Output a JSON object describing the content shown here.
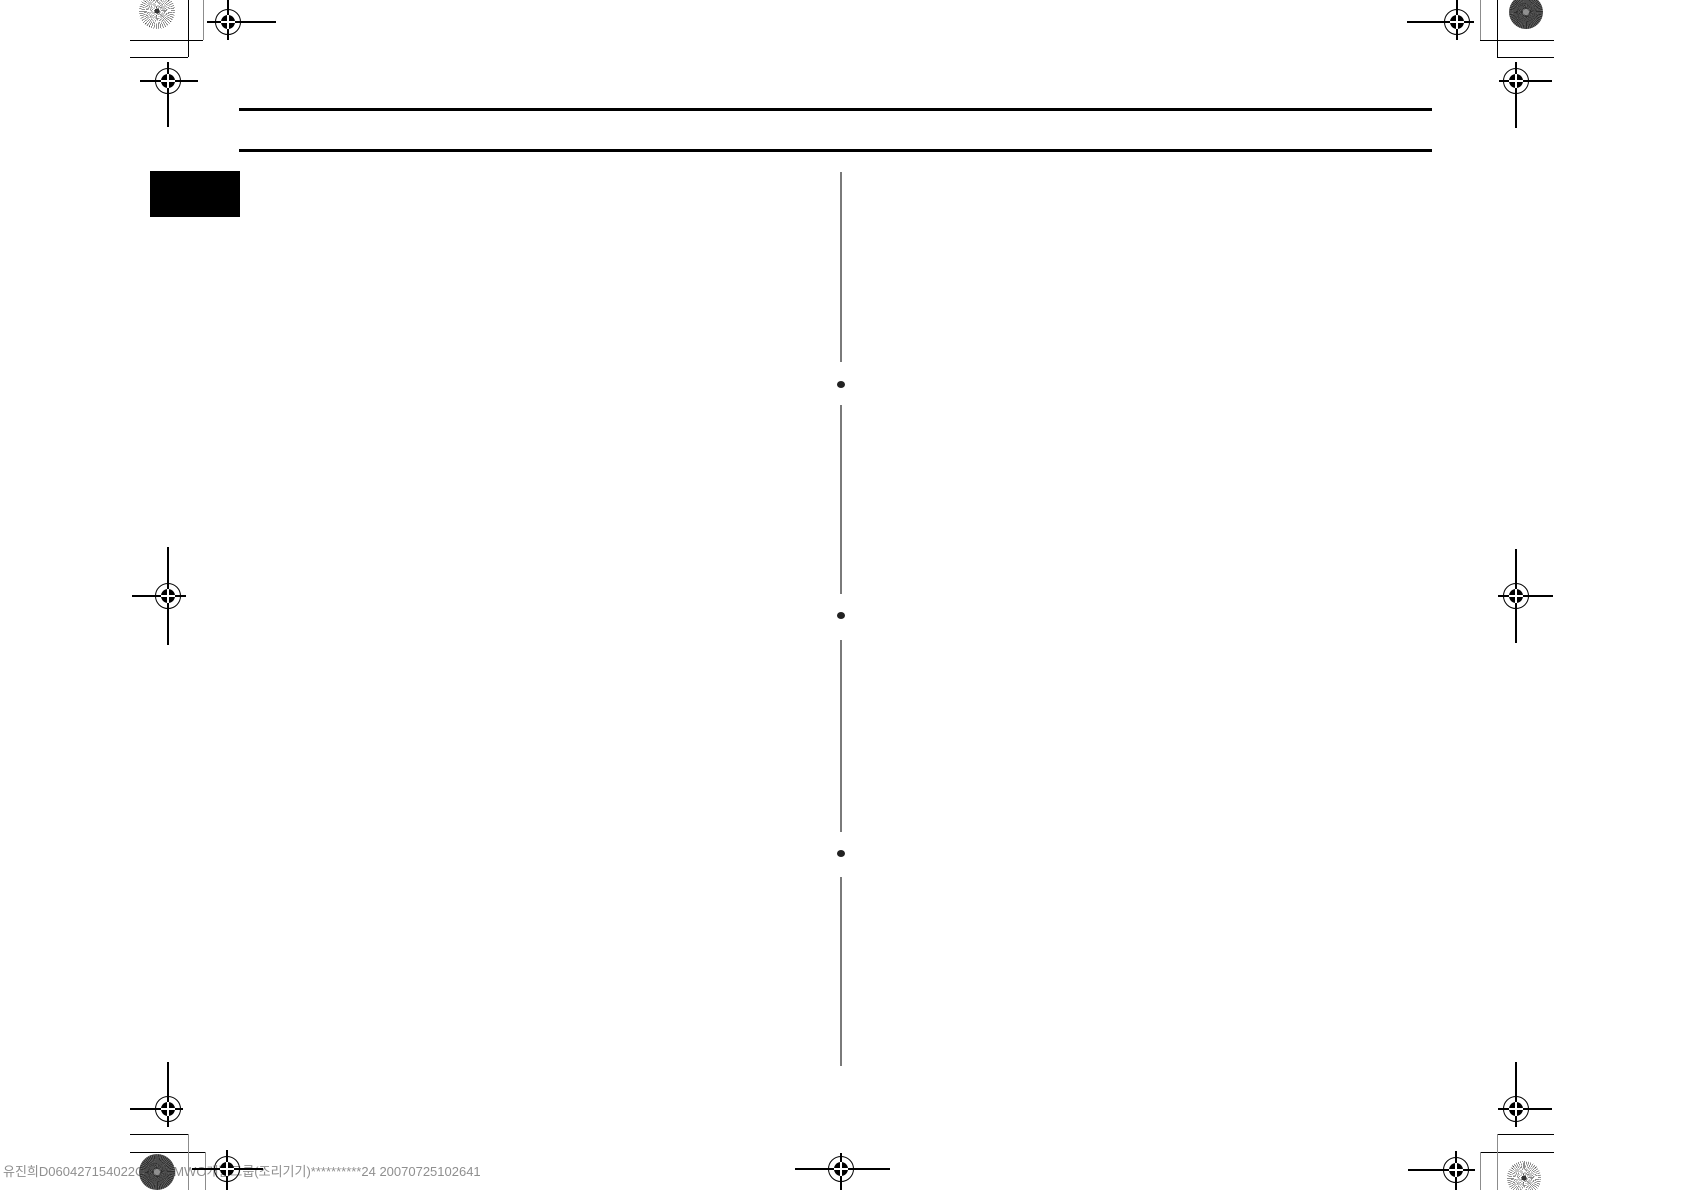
{
  "page": {
    "width": 1684,
    "height": 1190,
    "background": "#ffffff"
  },
  "footer": {
    "left_text": "유진희D060427154022C1",
    "right_text": "2MWO개발그룹(조리기기)**********24 20070725102641"
  },
  "colors": {
    "rule": "#000000",
    "tab": "#000000",
    "divider": "#7a7a7a",
    "bullet": "#222222",
    "mark": "#000000",
    "mark_gray": "#8c8c8c",
    "footer": "#8f8f8f"
  },
  "geometry": {
    "header_rules": [
      {
        "x": 239,
        "y": 108,
        "w": 1193,
        "h": 3
      },
      {
        "x": 239,
        "y": 149,
        "w": 1193,
        "h": 3
      }
    ],
    "section_tab": {
      "x": 150,
      "y": 171,
      "w": 90,
      "h": 46
    },
    "divider": {
      "x": 840,
      "w": 2,
      "segments": [
        [
          172,
          362
        ],
        [
          405,
          594
        ],
        [
          640,
          832
        ],
        [
          877,
          1066
        ]
      ]
    },
    "bullets": [
      {
        "x": 841,
        "y": 384
      },
      {
        "x": 841,
        "y": 615
      },
      {
        "x": 841,
        "y": 853
      }
    ],
    "reg_marks": [
      {
        "x": 228,
        "y": 22,
        "l": 21,
        "r": 48,
        "u": 22,
        "d": 18
      },
      {
        "x": 168,
        "y": 81,
        "l": 28,
        "r": 30,
        "u": 19,
        "d": 46
      },
      {
        "x": 1457,
        "y": 22,
        "l": 50,
        "r": 17,
        "u": 22,
        "d": 18
      },
      {
        "x": 1516,
        "y": 81,
        "l": 17,
        "r": 36,
        "u": 19,
        "d": 47
      },
      {
        "x": 168,
        "y": 596,
        "l": 36,
        "r": 18,
        "u": 49,
        "d": 49
      },
      {
        "x": 1516,
        "y": 596,
        "l": 18,
        "r": 37,
        "u": 47,
        "d": 47
      },
      {
        "x": 168,
        "y": 1109,
        "l": 38,
        "r": 15,
        "u": 47,
        "d": 18
      },
      {
        "x": 1516,
        "y": 1109,
        "l": 18,
        "r": 36,
        "u": 47,
        "d": 18
      },
      {
        "x": 227,
        "y": 1169,
        "l": 35,
        "r": 36,
        "u": 19,
        "d": 21
      },
      {
        "x": 1456,
        "y": 1170,
        "l": 48,
        "r": 19,
        "u": 19,
        "d": 20
      },
      {
        "x": 841,
        "y": 1169,
        "l": 46,
        "r": 49,
        "u": 16,
        "d": 21
      }
    ],
    "pinwheels": [
      {
        "x": 157,
        "y": 11,
        "r": 18,
        "v": "light"
      },
      {
        "x": 1526,
        "y": 12,
        "r": 17,
        "v": "dark"
      },
      {
        "x": 157,
        "y": 1172,
        "r": 18,
        "v": "dark"
      },
      {
        "x": 1524,
        "y": 1178,
        "r": 17,
        "v": "light"
      }
    ],
    "corner_lines": [
      {
        "x": 130,
        "y": 40,
        "w": 73,
        "h": 1.4,
        "s": "k"
      },
      {
        "x": 130,
        "y": 57,
        "w": 58,
        "h": 1.4,
        "s": "k"
      },
      {
        "x": 188,
        "y": 0,
        "w": 1.4,
        "h": 57,
        "s": "k"
      },
      {
        "x": 203,
        "y": 0,
        "w": 1.2,
        "h": 40,
        "s": "g"
      },
      {
        "x": 1480,
        "y": 40,
        "w": 74,
        "h": 1.4,
        "s": "k"
      },
      {
        "x": 1497,
        "y": 57,
        "w": 57,
        "h": 1.4,
        "s": "k"
      },
      {
        "x": 1497,
        "y": 0,
        "w": 1.4,
        "h": 57,
        "s": "k"
      },
      {
        "x": 1480,
        "y": 0,
        "w": 1.2,
        "h": 40,
        "s": "g"
      },
      {
        "x": 130,
        "y": 1134,
        "w": 58,
        "h": 1.4,
        "s": "k"
      },
      {
        "x": 130,
        "y": 1152,
        "w": 75,
        "h": 1.4,
        "s": "k"
      },
      {
        "x": 188,
        "y": 1134,
        "w": 1.2,
        "h": 56,
        "s": "g"
      },
      {
        "x": 205,
        "y": 1152,
        "w": 1.2,
        "h": 38,
        "s": "g"
      },
      {
        "x": 1497,
        "y": 1134,
        "w": 57,
        "h": 1.4,
        "s": "k"
      },
      {
        "x": 1480,
        "y": 1152,
        "w": 74,
        "h": 1.4,
        "s": "k"
      },
      {
        "x": 1497,
        "y": 1134,
        "w": 1.2,
        "h": 56,
        "s": "g"
      },
      {
        "x": 1480,
        "y": 1152,
        "w": 1.2,
        "h": 38,
        "s": "g"
      }
    ],
    "footer_left": {
      "x": 3,
      "y": 1163
    },
    "footer_right": {
      "x": 166,
      "y": 1163
    }
  }
}
